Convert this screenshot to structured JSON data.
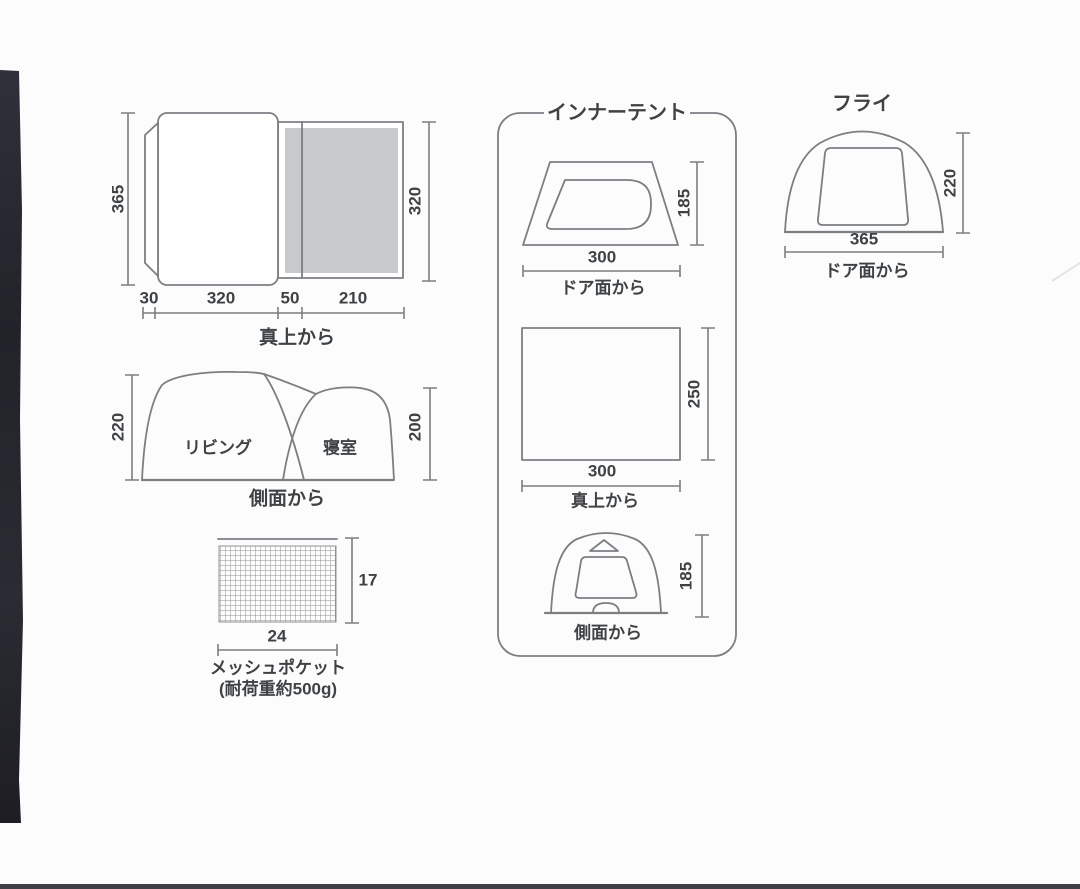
{
  "colors": {
    "background": "#fcfcfc",
    "line": "#7b7f82",
    "text": "#3f4245",
    "gray_fill": "#c8c9ca",
    "photo_strip": "#26262b",
    "bottom_bar": "#3e3e44"
  },
  "overall_top_view": {
    "caption": "真上から",
    "height_left": "365",
    "height_right": "320",
    "seg_1": "30",
    "seg_2": "320",
    "seg_3": "50",
    "seg_4": "210"
  },
  "overall_side_view": {
    "caption": "側面から",
    "height_left": "220",
    "height_right": "200",
    "label_living": "リビング",
    "label_bedroom": "寝室"
  },
  "mesh_pocket": {
    "caption": "メッシュポケット",
    "note": "(耐荷重約500g)",
    "width": "24",
    "height": "17"
  },
  "inner_tent": {
    "title": "インナーテント",
    "door_view": {
      "caption": "ドア面から",
      "width": "300",
      "height": "185"
    },
    "top_view": {
      "caption": "真上から",
      "width": "300",
      "depth": "250"
    },
    "side_view": {
      "caption": "側面から",
      "height": "185"
    }
  },
  "fly": {
    "title": "フライ",
    "caption": "ドア面から",
    "width": "365",
    "height": "220"
  }
}
